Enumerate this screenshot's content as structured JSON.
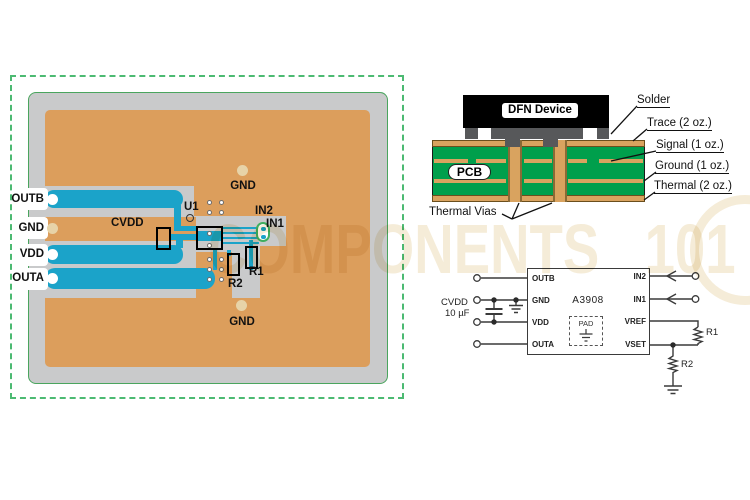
{
  "watermark": {
    "text_main": "COMPONENTS",
    "text_suffix": "101"
  },
  "pcb_layout": {
    "pad_labels": [
      "OUTB",
      "GND",
      "VDD",
      "OUTA"
    ],
    "component_labels": {
      "u1": "U1",
      "cvdd": "CVDD",
      "in2": "IN2",
      "in1": "IN1",
      "r1": "R1",
      "r2": "R2",
      "gnd_top": "GND",
      "gnd_bottom": "GND"
    },
    "colors": {
      "copper_pour": "#DC9E5C",
      "trace_teal": "#1BA3C9",
      "substrate_gray": "#C9CACB",
      "board_outline_green": "#4AA55E",
      "dashed_border_green": "#4CBA72"
    }
  },
  "cross_section": {
    "device_label": "DFN Device",
    "board_label": "PCB",
    "vias_label": "Thermal Vias",
    "layers": [
      "Solder",
      "Trace (2 oz.)",
      "Signal (1 oz.)",
      "Ground (1 oz.)",
      "Thermal (2 oz.)"
    ],
    "colors": {
      "board_green": "#009F4C",
      "copper_tan": "#D9A35F",
      "solder_gray": "#57585A",
      "device_black": "#000000"
    }
  },
  "schematic": {
    "ic_name": "A3908",
    "pad_label": "PAD",
    "left_pins": [
      "OUTB",
      "GND",
      "VDD",
      "OUTA"
    ],
    "right_pins": [
      "IN2",
      "IN1",
      "VREF",
      "VSET"
    ],
    "cap_name": "CVDD",
    "cap_value": "10 µF",
    "r1": "R1",
    "r2": "R2"
  }
}
